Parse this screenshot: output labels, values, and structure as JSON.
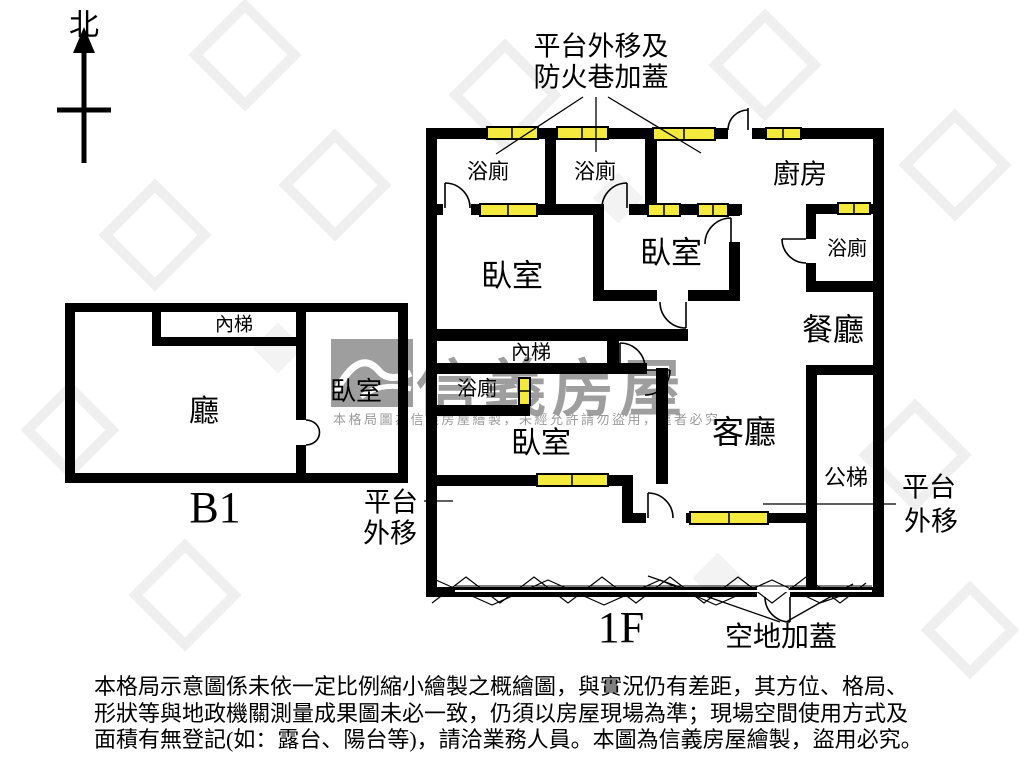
{
  "colors": {
    "background": "#ffffff",
    "wall": "#000000",
    "window_fill": "#f3ea3d",
    "watermark_gray": "#8e8e8e"
  },
  "compass": {
    "north_label": "北"
  },
  "top_annotation": {
    "line1": "平台外移及",
    "line2": "防火巷加蓋"
  },
  "first_floor": {
    "floor_label": "1F",
    "rooms": {
      "bathroom_top_left": "浴廁",
      "bathroom_top_middle": "浴廁",
      "kitchen": "廚房",
      "bathroom_right": "浴廁",
      "bedroom_left": "臥室",
      "bedroom_middle": "臥室",
      "dining_room": "餐廳",
      "inner_stairs": "內梯",
      "bathroom_center": "浴廁",
      "bedroom_lower": "臥室",
      "living_room": "客廳",
      "public_stairs": "公梯"
    },
    "annotations": {
      "platform_left_line1": "平台",
      "platform_left_line2": "外移",
      "platform_right_line1": "平台",
      "platform_right_line2": "外移",
      "yard_cover": "空地加蓋"
    }
  },
  "basement": {
    "floor_label": "B1",
    "rooms": {
      "inner_stairs": "內梯",
      "hall": "廳",
      "bedroom": "臥室"
    }
  },
  "watermark": {
    "brand": "信義房屋",
    "notice": "本格局圖為信義房屋繪製，未經允許請勿盜用，違者必究"
  },
  "disclaimer": {
    "line1": "本格局示意圖係未依一定比例縮小繪製之概繪圖，與實況仍有差距，其方位、格局、",
    "line2": "形狀等與地政機關測量成果圖未必一致，仍須以房屋現場為準；現場空間使用方式及",
    "line3": "面積有無登記(如：露台、陽台等)，請洽業務人員。本圖為信義房屋繪製，盜用必究。"
  }
}
